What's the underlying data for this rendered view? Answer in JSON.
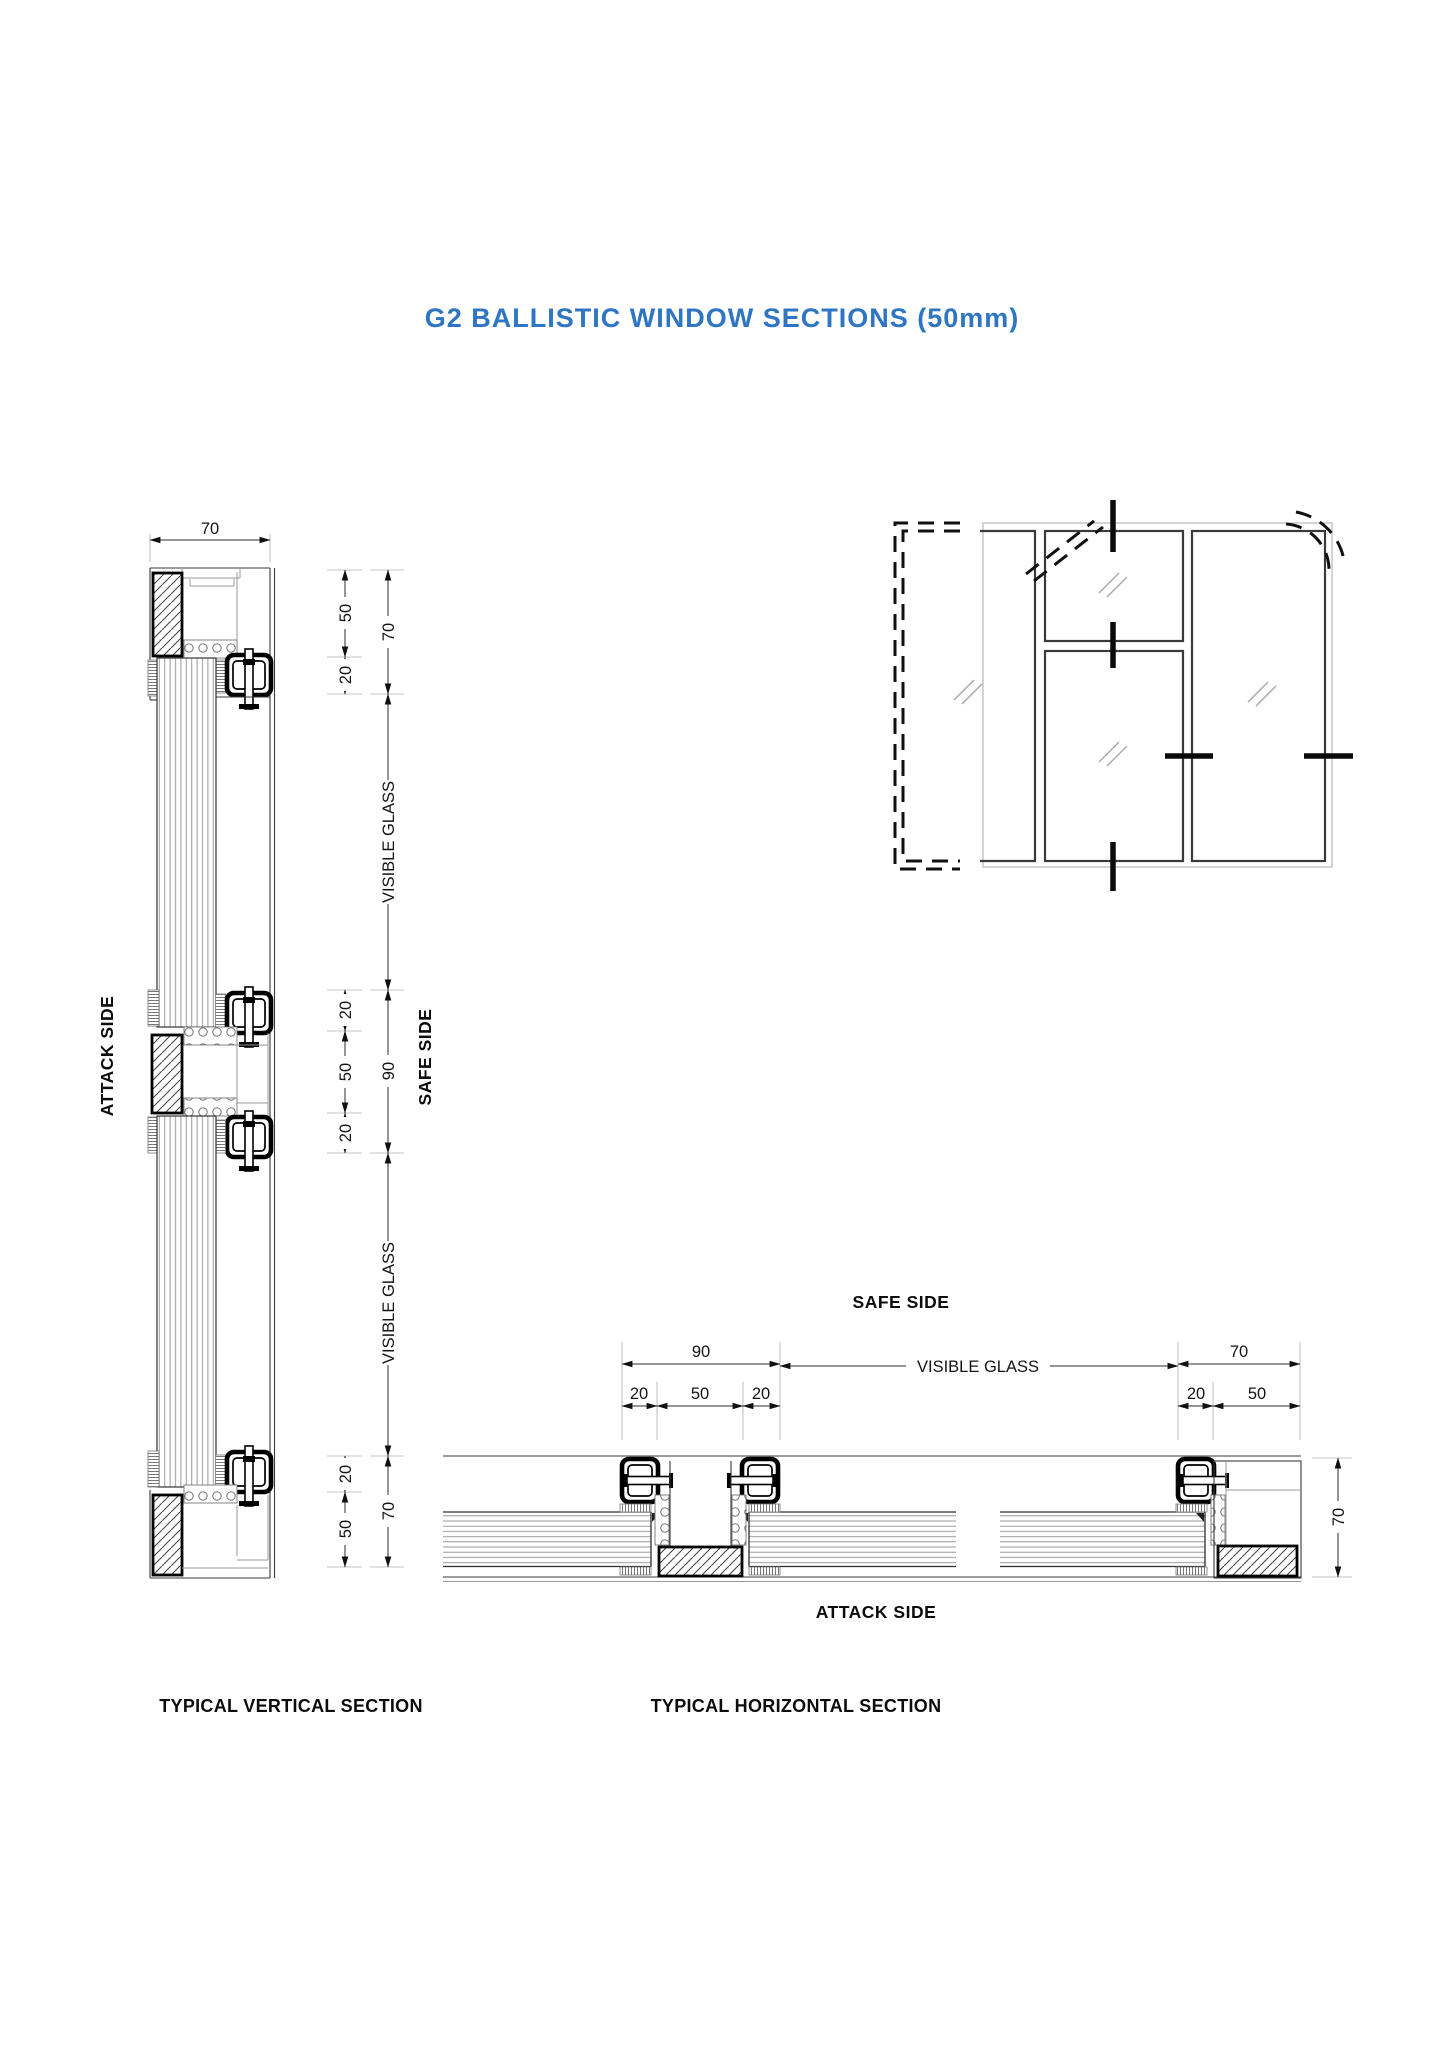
{
  "title": {
    "text": "G2 BALLISTIC WINDOW SECTIONS (50mm)",
    "color": "#2e75c4"
  },
  "vertical_section": {
    "caption": "TYPICAL VERTICAL SECTION",
    "attack_side_label": "ATTACK SIDE",
    "safe_side_label": "SAFE SIDE",
    "visible_glass_upper": "VISIBLE GLASS",
    "visible_glass_lower": "VISIBLE GLASS",
    "dims": {
      "head_width": "70",
      "head": [
        "50",
        "20"
      ],
      "head_overall": "70",
      "transom": [
        "20",
        "50",
        "20"
      ],
      "transom_overall": "90",
      "sill": [
        "20",
        "50"
      ],
      "sill_overall": "70"
    }
  },
  "horizontal_section": {
    "caption": "TYPICAL HORIZONTAL SECTION",
    "safe_side_label": "SAFE SIDE",
    "attack_side_label": "ATTACK SIDE",
    "visible_glass_label": "VISIBLE GLASS",
    "dims": {
      "mullion_overall": "90",
      "mullion": [
        "20",
        "50",
        "20"
      ],
      "jamb_overall": "70",
      "jamb": [
        "20",
        "50"
      ],
      "frame_depth": "70"
    }
  }
}
